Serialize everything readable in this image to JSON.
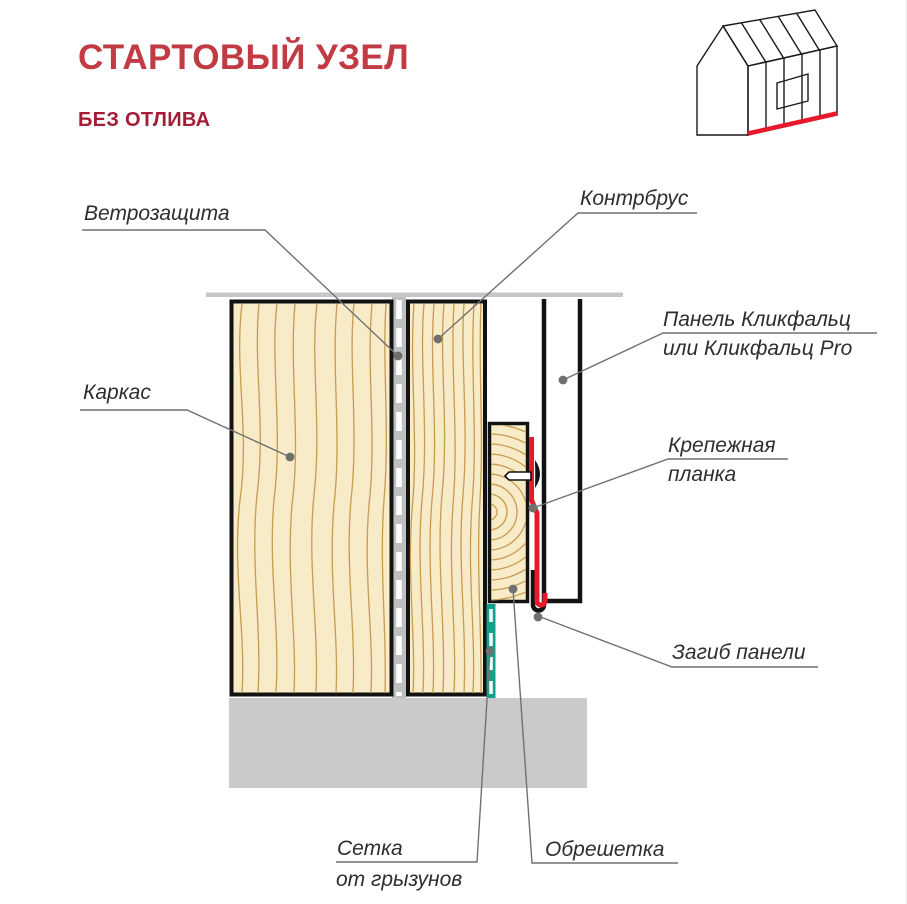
{
  "header": {
    "title": "СТАРТОВЫЙ УЗЕЛ",
    "subtitle": "БЕЗ ОТЛИВА"
  },
  "house_icon": {
    "name": "house-with-standing-seam-cladding-icon",
    "highlight_color": "#E8192C"
  },
  "diagram": {
    "labels": {
      "windbreak": "Ветрозащита",
      "counter_batten": "Контрбрус",
      "frame": "Каркас",
      "panel_line1": "Панель Кликфальц",
      "panel_line2": "или Кликфальц Pro",
      "fastening_line1": "Крепежная",
      "fastening_line2": "планка",
      "panel_fold": "Загиб панели",
      "mesh_line1": "Сетка",
      "mesh_line2": "от грызунов",
      "lathing": "Обрешетка"
    }
  },
  "colors": {
    "title_red": "#C23B44",
    "subtitle_red": "#A31D37",
    "wood_fill": "#F7EBC8",
    "wood_grain": "#C79B52",
    "outline_black": "#121212",
    "membrane_gray": "#BFBFBF",
    "boundary_gray": "#C6C6C6",
    "base_gray": "#CACACA",
    "mesh_teal": "#14A18B",
    "clip_red": "#E8192C",
    "leader_gray": "#717171",
    "label_color": "#2E2E2E"
  }
}
